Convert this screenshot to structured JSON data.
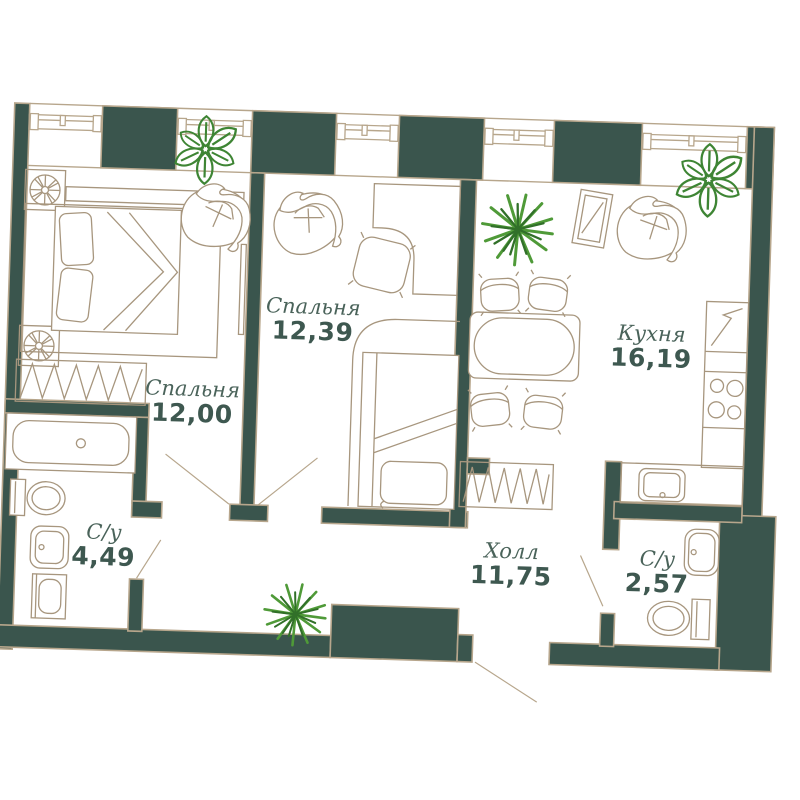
{
  "floorplan": {
    "type": "apartment-floor-plan",
    "rooms": [
      {
        "id": "bedroom-2",
        "name": "Спальня",
        "area": "12,39"
      },
      {
        "id": "bedroom-1",
        "name": "Спальня",
        "area": "12,00"
      },
      {
        "id": "kitchen",
        "name": "Кухня",
        "area": "16,19"
      },
      {
        "id": "hall",
        "name": "Холл",
        "area": "11,75"
      },
      {
        "id": "bathroom-1",
        "name": "С/у",
        "area": "4,49"
      },
      {
        "id": "bathroom-2",
        "name": "С/у",
        "area": "2,57"
      }
    ],
    "colors": {
      "wall": "#3a554d",
      "outline": "#b7a68c",
      "furniture": "#a7967e",
      "door_line": "#b7a68c",
      "room_name": "#4a635a",
      "room_number": "#3e5850",
      "plant_bright": "#4f9a38",
      "plant_dark": "#317029",
      "plant_leaf": "#3e8534"
    }
  }
}
